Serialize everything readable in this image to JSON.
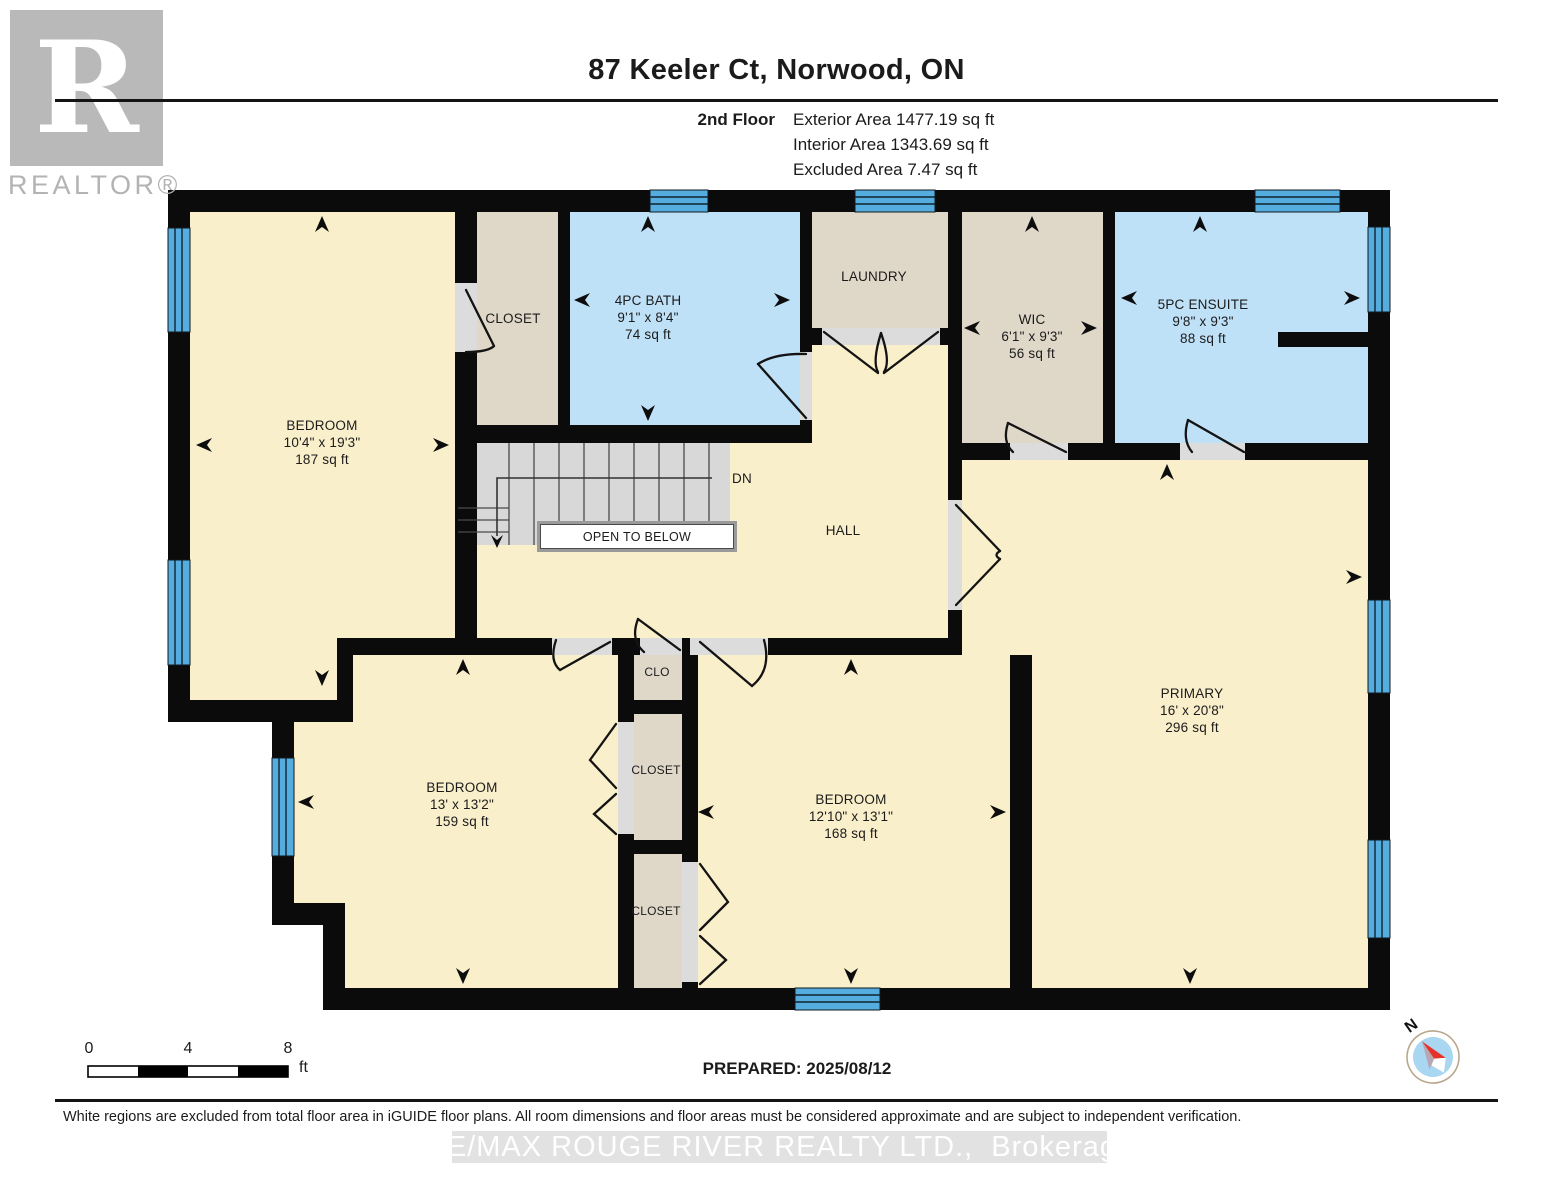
{
  "header": {
    "logo_letter": "R",
    "logo_text": "REALTOR®",
    "title": "87 Keeler Ct, Norwood, ON",
    "floor_label": "2nd Floor",
    "area_lines": [
      "Exterior Area 1477.19 sq ft",
      "Interior Area 1343.69 sq ft",
      "Excluded Area 7.47 sq ft"
    ]
  },
  "rooms": {
    "bedroom1": {
      "name": "BEDROOM",
      "dims": "10'4\" x 19'3\"",
      "area": "187 sq ft"
    },
    "closet_top": {
      "name": "CLOSET"
    },
    "bath": {
      "name": "4PC BATH",
      "dims": "9'1\" x 8'4\"",
      "area": "74 sq ft"
    },
    "laundry": {
      "name": "LAUNDRY"
    },
    "wic": {
      "name": "WIC",
      "dims": "6'1\" x 9'3\"",
      "area": "56 sq ft"
    },
    "ensuite": {
      "name": "5PC ENSUITE",
      "dims": "9'8\" x 9'3\"",
      "area": "88 sq ft"
    },
    "hall": {
      "name": "HALL"
    },
    "primary": {
      "name": "PRIMARY",
      "dims": "16' x 20'8\"",
      "area": "296 sq ft"
    },
    "bedroom2": {
      "name": "BEDROOM",
      "dims": "13' x 13'2\"",
      "area": "159 sq ft"
    },
    "bedroom3": {
      "name": "BEDROOM",
      "dims": "12'10\" x 13'1\"",
      "area": "168 sq ft"
    },
    "clo": {
      "name": "CLO"
    },
    "closet_mid": {
      "name": "CLOSET"
    },
    "closet_bot": {
      "name": "CLOSET"
    }
  },
  "stairs": {
    "dn_label": "DN",
    "open_to_below": "OPEN TO BELOW"
  },
  "scale_bar": {
    "t0": "0",
    "t4": "4",
    "t8": "8",
    "unit": "ft"
  },
  "prepared": "PREPARED: 2025/08/12",
  "compass": {
    "north_label": "N"
  },
  "footer": {
    "disclaimer": "White regions are excluded from total floor area in iGUIDE floor plans. All room dimensions and floor areas must be considered approximate and are subject to independent verification.",
    "watermark": "RE/MAX ROUGE RIVER REALTY LTD.,  Brokerage"
  },
  "colors": {
    "cream": "#FAEFCB",
    "tan": "#DFD8C9",
    "room_blue": "#BFE1F7",
    "window_blue": "#55ACDF",
    "wall": "#0b0b0b",
    "stair_gray": "#D8D8D8",
    "gap_gray": "#DCDCDC",
    "watermark_band": "#e2e2e2",
    "compass_red": "#e63329",
    "compass_inner": "#a9d6f0"
  }
}
